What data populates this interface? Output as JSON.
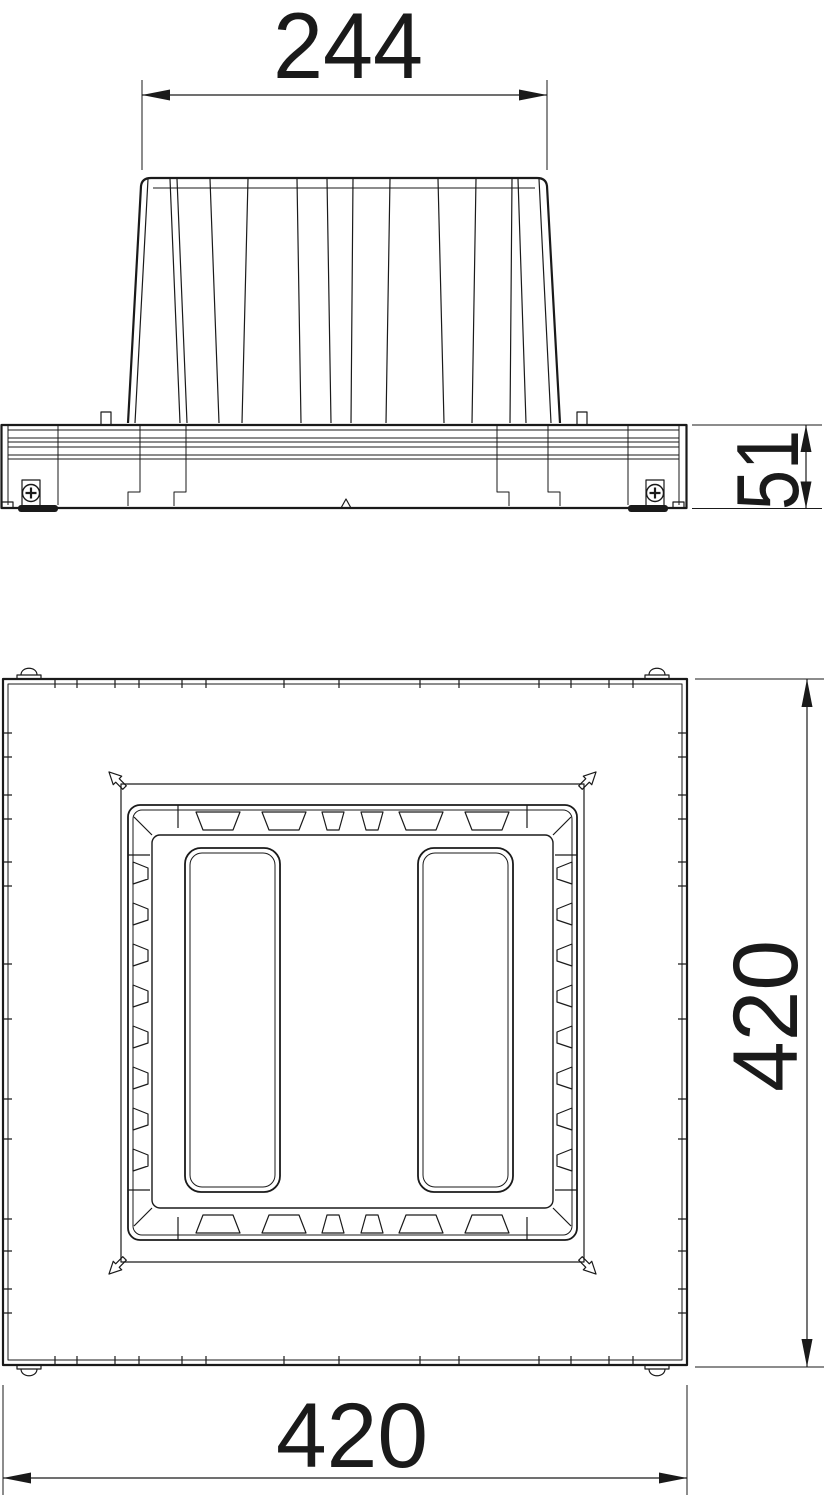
{
  "page": {
    "background": "#ffffff"
  },
  "drawing": {
    "style": "black-line technical drawing, two orthographic views",
    "line_color": "#1a1a1a",
    "views": [
      {
        "id": "side-view"
      },
      {
        "id": "plan-view"
      }
    ]
  },
  "dims": {
    "top_width": {
      "value": "244",
      "orientation": "horizontal",
      "view": "side-view"
    },
    "base_height": {
      "value": "51",
      "orientation": "vertical",
      "view": "side-view"
    },
    "plan_height": {
      "value": "420",
      "orientation": "vertical",
      "view": "plan-view"
    },
    "plan_width": {
      "value": "420",
      "orientation": "horizontal",
      "view": "plan-view"
    }
  }
}
